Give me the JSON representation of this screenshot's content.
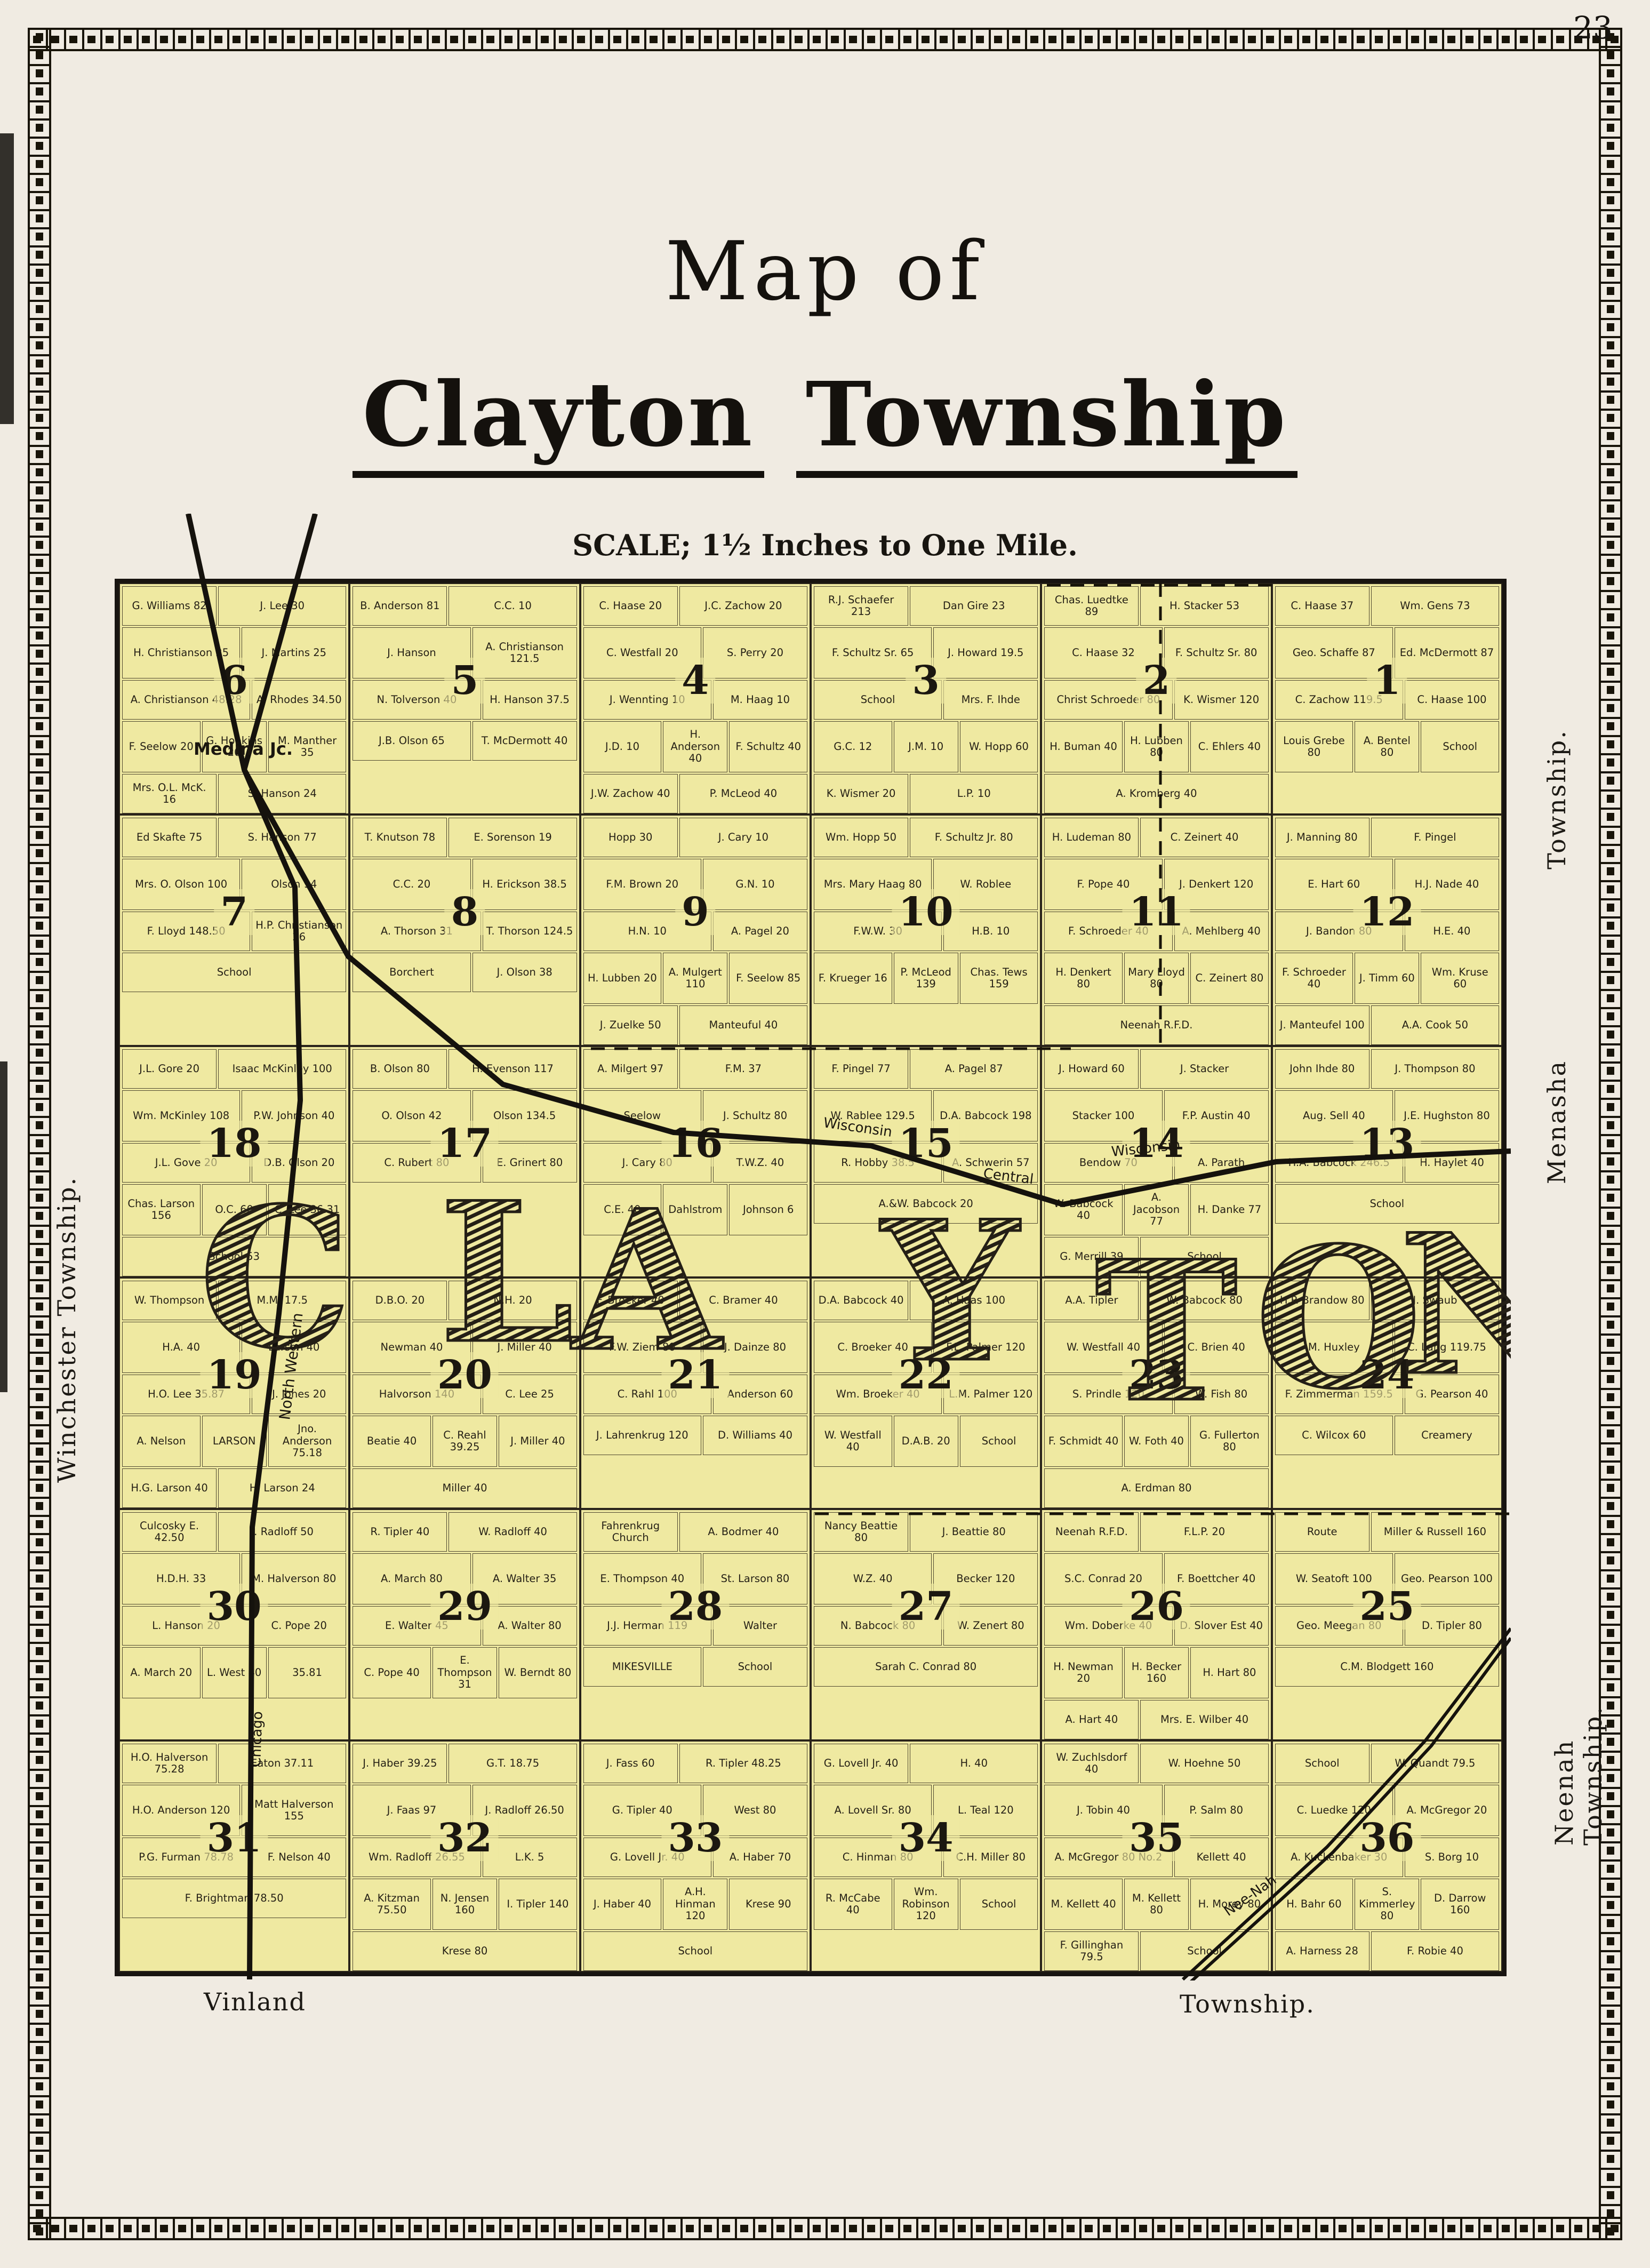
{
  "page": {
    "number": "23"
  },
  "title": {
    "line1": "Map of",
    "word1": "Clayton",
    "word2": "Township",
    "scale": "SCALE;  1½ Inches to One Mile."
  },
  "map": {
    "overlay_letters": [
      "C",
      "L",
      "A",
      "Y",
      "T",
      "O",
      "N"
    ],
    "rail_labels": {
      "medina": "Medina Jc.",
      "wisconsin_a": "Wisconsin",
      "central": "Central",
      "wisconsin_b": "Wisconsin",
      "north_western": "North Western",
      "chicago": "Chicago",
      "neenah": "Nee-Nah"
    },
    "edge_labels": {
      "left": "Winchester Township.",
      "right_top": "Township.",
      "right_middle": "Menasha",
      "right_bottom": "Neenah Township.",
      "bottom_left": "Vinland",
      "bottom_right": "Township."
    },
    "colors": {
      "paper": "#f0ebe2",
      "map_fill": "#efe9a1",
      "ink": "#181410"
    },
    "sections": [
      {
        "n": "6",
        "parcels": [
          "G. Williams 82",
          "J. Lee 30",
          "H. Christianson 25",
          "J. Martins 25",
          "A. Christianson 48.28",
          "A. Rhodes 34.50",
          "F. Seelow 20",
          "G. Hopkins 20",
          "M. Manther 35",
          "Mrs. O.L. McK. 16",
          "S. Hanson 24",
          "H.O. Thorsen 30",
          "Ed. Skafte 55",
          "G. Hanson 40"
        ]
      },
      {
        "n": "5",
        "parcels": [
          "B. Anderson 81",
          "C.C. 10",
          "J. Hanson",
          "A. Christianson 121.5",
          "N. Tolverson 40",
          "H. Hanson 37.5",
          "J.B. Olson 65",
          "T. McDermott 40"
        ]
      },
      {
        "n": "4",
        "parcels": [
          "C. Haase 20",
          "J.C. Zachow 20",
          "C. Westfall 20",
          "S. Perry 20",
          "J. Wennting 10",
          "M. Haag 10",
          "J.D. 10",
          "H. Anderson 40",
          "F. Schultz 40",
          "J.W. Zachow 40",
          "P. McLeod 40",
          "R. Ludeman 40"
        ]
      },
      {
        "n": "3",
        "parcels": [
          "R.J. Schaefer 213",
          "Dan Gire 23",
          "F. Schultz Sr. 65",
          "J. Howard 19.5",
          "School",
          "Mrs. F. Ihde",
          "G.C. 12",
          "J.M. 10",
          "W. Hopp 60",
          "K. Wismer 20",
          "L.P. 10"
        ]
      },
      {
        "n": "2",
        "parcels": [
          "Chas. Luedtke 89",
          "H. Stacker 53",
          "C. Haase 32",
          "F. Schultz Sr. 80",
          "Christ Schroeder 80",
          "K. Wismer 120",
          "H. Buman 40",
          "H. Lubben 80",
          "C. Ehlers 40",
          "A. Kromberg 40"
        ]
      },
      {
        "n": "1",
        "parcels": [
          "C. Haase 37",
          "Wm. Gens 73",
          "Geo. Schaffe 87",
          "Ed. McDermott 87",
          "C. Zachow 119.5",
          "C. Haase 100",
          "Louis Grebe 80",
          "A. Bentel 80",
          "School"
        ]
      },
      {
        "n": "7",
        "parcels": [
          "Ed Skafte 75",
          "S. Hanson 77",
          "Mrs. O. Olson 100",
          "Olson 94",
          "F. Lloyd 148.50",
          "H.P. Christianson 26",
          "School"
        ]
      },
      {
        "n": "8",
        "parcels": [
          "T. Knutson 78",
          "E. Sorenson 19",
          "C.C. 20",
          "H. Erickson 38.5",
          "A. Thorson 31",
          "T. Thorson 124.5",
          "Borchert",
          "J. Olson 38"
        ]
      },
      {
        "n": "9",
        "parcels": [
          "Hopp 30",
          "J. Cary 10",
          "F.M. Brown 20",
          "G.N. 10",
          "H.N. 10",
          "A. Pagel 20",
          "H. Lubben 20",
          "A. Mulgert 110",
          "F. Seelow 85",
          "J. Zuelke 50",
          "Manteuful 40",
          "Ludeman 40"
        ]
      },
      {
        "n": "10",
        "parcels": [
          "Wm. Hopp 50",
          "F. Schultz Jr. 80",
          "Mrs. Mary Haag 80",
          "W. Roblee",
          "F.W.W. 30",
          "H.B. 10",
          "F. Krueger 16",
          "P. McLeod 139",
          "Chas. Tews 159"
        ]
      },
      {
        "n": "11",
        "parcels": [
          "H. Ludeman 80",
          "C. Zeinert 40",
          "F. Pope 40",
          "J. Denkert 120",
          "F. Schroeder 40",
          "A. Mehlberg 40",
          "H. Denkert 80",
          "Mary Lloyd 80",
          "C. Zeinert 80",
          "Neenah R.F.D."
        ]
      },
      {
        "n": "12",
        "parcels": [
          "J. Manning 80",
          "F. Pingel",
          "E. Hart 60",
          "H.J. Nade 40",
          "J. Bandon 80",
          "H.E. 40",
          "F. Schroeder 40",
          "J. Timm 60",
          "Wm. Kruse 60",
          "J. Manteufel 100",
          "A.A. Cook 50"
        ]
      },
      {
        "n": "18",
        "parcels": [
          "J.L. Gore 20",
          "Isaac McKinley 100",
          "Wm. McKinley 108",
          "P.W. Johnson 40",
          "J.L. Gove 20",
          "D.B. Olson 20",
          "Chas. Larson 156",
          "O.C. 60",
          "C. Lee 36.31",
          "School 53"
        ]
      },
      {
        "n": "17",
        "parcels": [
          "B. Olson 80",
          "H. Evenson 117",
          "O. Olson 42",
          "Olson 134.5",
          "C. Rubert 80",
          "E. Grinert 80"
        ]
      },
      {
        "n": "16",
        "parcels": [
          "A. Milgert 97",
          "F.M. 37",
          "Seelow",
          "J. Schultz 80",
          "J. Cary 80",
          "T.W.Z. 40",
          "C.E. 40",
          "Dahlstrom",
          "Johnson 6"
        ]
      },
      {
        "n": "15",
        "parcels": [
          "F. Pingel 77",
          "A. Pagel 87",
          "W. Rablee 129.5",
          "D.A. Babcock 198",
          "R. Hobby 38.5",
          "A. Schwerin 57",
          "A.&W. Babcock 20"
        ]
      },
      {
        "n": "14",
        "parcels": [
          "J. Howard 60",
          "J. Stacker",
          "Stacker 100",
          "F.P. Austin 40",
          "Bendow 70",
          "A. Parath",
          "W. Babcock 40",
          "A. Jacobson 77",
          "H. Danke 77",
          "G. Merrill 39",
          "School"
        ]
      },
      {
        "n": "13",
        "parcels": [
          "John Ihde 80",
          "J. Thompson 80",
          "Aug. Sell 40",
          "J.E. Hughston 80",
          "H.A. Babcock 246.5",
          "H. Haylet 40",
          "School"
        ]
      },
      {
        "n": "19",
        "parcels": [
          "W. Thompson",
          "M.M. 17.5",
          "H.A. 40",
          "Larson 40",
          "H.O. Lee 35.87",
          "J. Jones 20",
          "A. Nelson",
          "LARSON",
          "Jno. Anderson 75.18",
          "H.G. Larson 40",
          "H. Larson 24"
        ]
      },
      {
        "n": "20",
        "parcels": [
          "D.B.O. 20",
          "N.H. 20",
          "Newman 40",
          "J. Miller 40",
          "Halvorson 140",
          "C. Lee 25",
          "Beatie 40",
          "C. Reahl 39.25",
          "J. Miller 40",
          "Miller 40"
        ]
      },
      {
        "n": "21",
        "parcels": [
          "F. Broeker 40",
          "C. Bramer 40",
          "F.W. Ziem 80",
          "J. Dainze 80",
          "C. Rahl 100",
          "Anderson 60",
          "J. Lahrenkrug 120",
          "D. Williams 40"
        ]
      },
      {
        "n": "22",
        "parcels": [
          "D.A. Babcock 40",
          "A. Haas 100",
          "C. Broeker 40",
          "F.L. Palmer 120",
          "Wm. Broeker 40",
          "L.M. Palmer 120",
          "W. Westfall 40",
          "D.A.B. 20",
          "School"
        ]
      },
      {
        "n": "23",
        "parcels": [
          "A.A. Tipler",
          "W. Babcock 80",
          "W. Westfall 40",
          "C. Brien 40",
          "S. Prindle 120",
          "W. Fish 80",
          "F. Schmidt 40",
          "W. Foth 40",
          "G. Fullerton 80",
          "A. Erdman 80"
        ]
      },
      {
        "n": "24",
        "parcels": [
          "H.P. Brandow 80",
          "J. Swaub",
          "M. Huxley",
          "C. Lang 119.75",
          "F. Zimmerman 159.5",
          "G. Pearson 40",
          "C. Wilcox 60",
          "Creamery"
        ]
      },
      {
        "n": "30",
        "parcels": [
          "Culcosky E. 42.50",
          "J. Radloff 50",
          "H.D.H. 33",
          "M. Halverson 80",
          "L. Hanson 20",
          "C. Pope 20",
          "A. March 20",
          "L. West 40",
          "35.81"
        ]
      },
      {
        "n": "29",
        "parcels": [
          "R. Tipler 40",
          "W. Radloff 40",
          "A. March 80",
          "A. Walter 35",
          "E. Walter 45",
          "A. Walter 80",
          "C. Pope 40",
          "E. Thompson 31",
          "W. Berndt 80"
        ]
      },
      {
        "n": "28",
        "parcels": [
          "Fahrenkrug Church",
          "A. Bodmer 40",
          "E. Thompson 40",
          "St. Larson 80",
          "J.J. Herman 119",
          "Walter",
          "MIKESVILLE",
          "School"
        ]
      },
      {
        "n": "27",
        "parcels": [
          "Nancy Beattie 80",
          "J. Beattie 80",
          "W.Z. 40",
          "Becker 120",
          "N. Babcock 80",
          "W. Zenert 80",
          "Sarah C. Conrad 80"
        ]
      },
      {
        "n": "26",
        "parcels": [
          "Neenah R.F.D.",
          "F.L.P. 20",
          "S.C. Conrad 20",
          "F. Boettcher 40",
          "Wm. Doberke 40",
          "D. Slover Est 40",
          "H. Newman 20",
          "H. Becker 160",
          "H. Hart 80",
          "A. Hart 40",
          "Mrs. E. Wilber 40"
        ]
      },
      {
        "n": "25",
        "parcels": [
          "Route",
          "Miller & Russell 160",
          "W. Seatoft 100",
          "Geo. Pearson 100",
          "Geo. Meegan 80",
          "D. Tipler 80",
          "C.M. Blodgett 160"
        ]
      },
      {
        "n": "31",
        "parcels": [
          "H.O. Halverson 75.28",
          "Eaton 37.11",
          "H.O. Anderson 120",
          "Matt Halverson 155",
          "P.G. Furman 78.78",
          "F. Nelson 40",
          "F. Brightman 78.50"
        ]
      },
      {
        "n": "32",
        "parcels": [
          "J. Haber 39.25",
          "G.T. 18.75",
          "J. Faas 97",
          "J. Radloff 26.50",
          "Wm. Radloff 26.55",
          "L.K. 5",
          "A. Kitzman 75.50",
          "N. Jensen 160",
          "I. Tipler 140",
          "Krese 80"
        ]
      },
      {
        "n": "33",
        "parcels": [
          "J. Fass 60",
          "R. Tipler 48.25",
          "G. Tipler 40",
          "West 80",
          "G. Lovell Jr. 40",
          "A. Haber 70",
          "J. Haber 40",
          "A.H. Hinman 120",
          "Krese 90",
          "School"
        ]
      },
      {
        "n": "34",
        "parcels": [
          "G. Lovell Jr. 40",
          "H. 40",
          "A. Lovell Sr. 80",
          "L. Teal 120",
          "C. Hinman 80",
          "C.H. Miller 80",
          "R. McCabe 40",
          "Wm. Robinson 120",
          "School"
        ]
      },
      {
        "n": "35",
        "parcels": [
          "W. Zuchlsdorf 40",
          "W. Hoehne 50",
          "J. Tobin 40",
          "P. Salm 80",
          "A. McGregor 80 No.2",
          "Kellett 40",
          "M. Kellett 40",
          "M. Kellett 80",
          "H. Morey 80",
          "F. Gillinghan 79.5",
          "School"
        ]
      },
      {
        "n": "36",
        "parcels": [
          "School",
          "W. Quandt 79.5",
          "C. Luedke 120",
          "A. McGregor 20",
          "A. Kuckenbaker 30",
          "S. Borg 10",
          "H. Bahr 60",
          "S. Kimmerley 80",
          "D. Darrow 160",
          "A. Harness 28",
          "F. Robie 40"
        ]
      }
    ]
  }
}
